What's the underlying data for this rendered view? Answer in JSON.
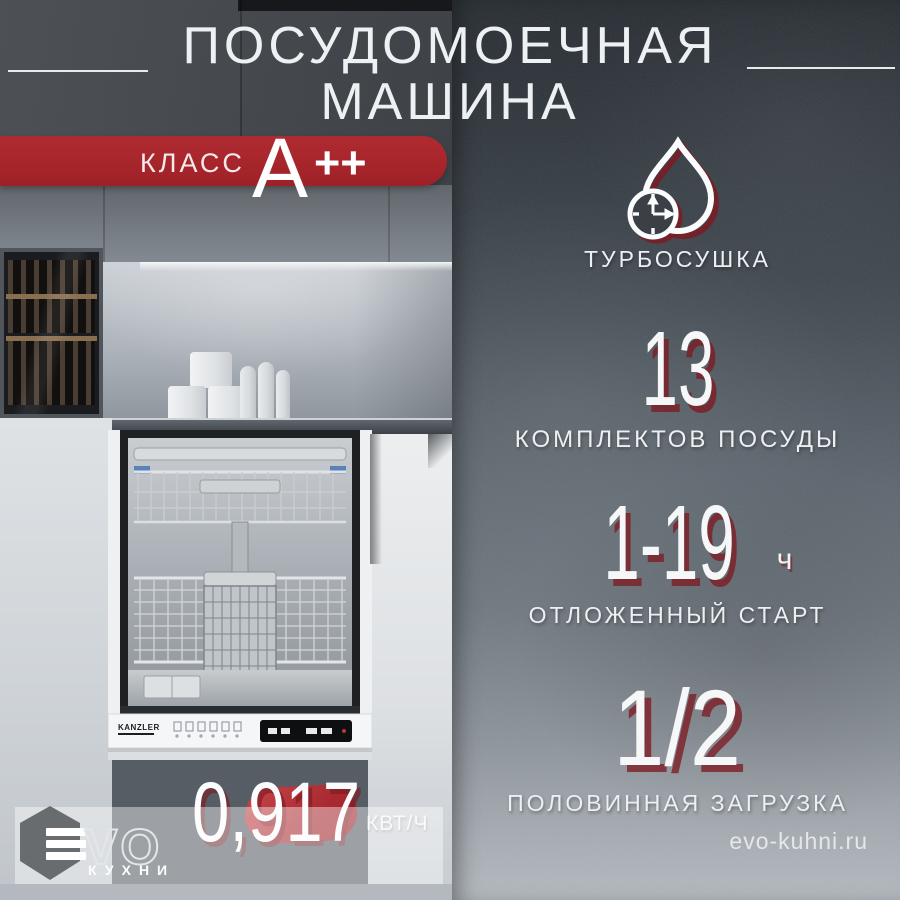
{
  "title": {
    "line1": "ПОСУДОМОЕЧНАЯ",
    "line2": "МАШИНА"
  },
  "badge": {
    "label": "КЛАСС",
    "grade": "A",
    "plus": "++"
  },
  "features": {
    "turbo": {
      "icon": "water-drop-timer-icon",
      "label": "ТУРБОСУШКА"
    },
    "sets": {
      "value": "13",
      "label": "КОМПЛЕКТОВ ПОСУДЫ"
    },
    "delay": {
      "value": "1-19",
      "unit": "ч",
      "label": "ОТЛОЖЕННЫЙ СТАРТ"
    },
    "half": {
      "value": "1/2",
      "label": "ПОЛОВИННАЯ ЗАГРУЗКА"
    }
  },
  "energy": {
    "value": "0,917",
    "unit": "КВТ/Ч"
  },
  "logo": {
    "text": "VO",
    "caption": "КУХНИ"
  },
  "website": "evo-kuhni.ru",
  "appliance": {
    "brand": "KANZLER"
  },
  "colors": {
    "accent_red": "#a8262c",
    "shadow_red": "#7d1b22",
    "background_dark": "#2c3237"
  }
}
